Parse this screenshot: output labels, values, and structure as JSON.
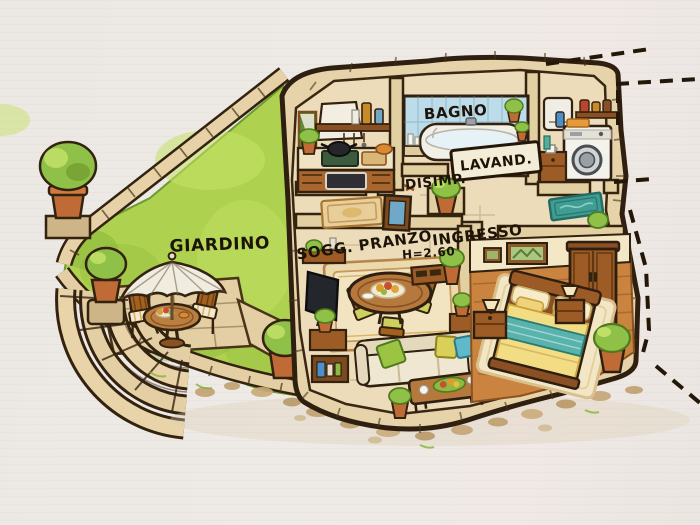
{
  "scene": {
    "kind": "hand-drawn watercolor floor plan with garden",
    "view": "top-down slightly isometric"
  },
  "labels": {
    "garden": "GIARDINO",
    "bathroom": "BAGNO",
    "laundry": "LAVAND.",
    "hallway": "DISIMP.",
    "living_dining": "SOGG. PRANZO",
    "entrance": "INGRESSO",
    "ceiling_height": "H=2.60"
  },
  "colors": {
    "paper": "#ece8e4",
    "ink_outline": "#2e1f10",
    "stone_wall": "#e6d3a9",
    "stone_floor": "#ecdcba",
    "grass": "#aed24f",
    "grass_light": "#c6e26a",
    "grass_dark": "#86b138",
    "wood": "#a9672f",
    "wood_floor": "#ca8440",
    "terracotta": "#c06a35",
    "tile_blue": "#bcdcea",
    "blanket_teal": "#58b3ac",
    "bedding_yellow": "#f2dc84",
    "doormat_teal": "#3f9d94",
    "sofa_cream": "#efe7d2"
  }
}
